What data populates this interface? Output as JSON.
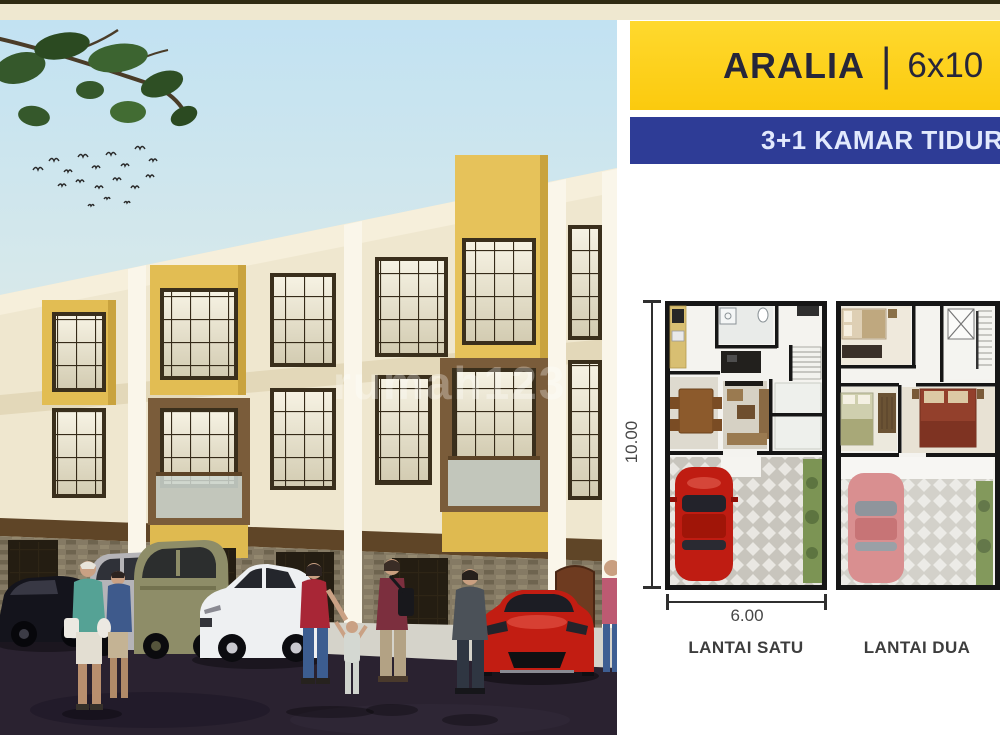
{
  "frame": {
    "top_line_color": "#2f2b12",
    "top_band_color": "#efe8d0",
    "background": "#ffffff"
  },
  "photo": {
    "watermark_text": "rumah123"
  },
  "header": {
    "project_name": "ARALIA",
    "separator": "|",
    "unit_size": "6x10",
    "background": "#ffd31b",
    "text_color": "#26263a"
  },
  "subheader": {
    "text": "3+1 KAMAR TIDUR",
    "background": "#2e3c96",
    "text_color": "#e2e9fd"
  },
  "plans": {
    "height_dimension": "10.00",
    "width_dimension": "6.00",
    "floor_one_label": "LANTAI SATU",
    "floor_two_label": "LANTAI DUA"
  }
}
